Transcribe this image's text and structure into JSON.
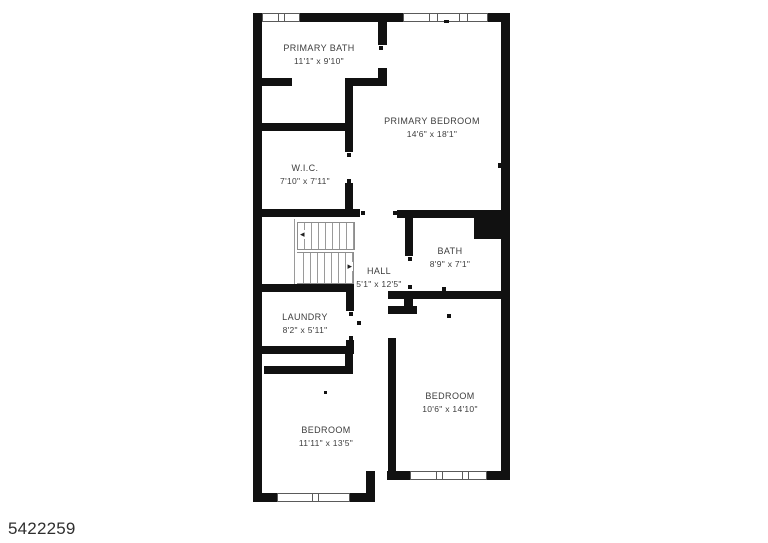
{
  "plan": {
    "listing_id": "5422259",
    "rooms": [
      {
        "name": "PRIMARY BATH",
        "dims": "11'1\" x 9'10\""
      },
      {
        "name": "PRIMARY BEDROOM",
        "dims": "14'6\" x 18'1\""
      },
      {
        "name": "W.I.C.",
        "dims": "7'10\" x 7'11\""
      },
      {
        "name": "HALL",
        "dims": "5'1\" x 12'5\""
      },
      {
        "name": "BATH",
        "dims": "8'9\" x 7'1\""
      },
      {
        "name": "LAUNDRY",
        "dims": "8'2\" x 5'11\""
      },
      {
        "name": "BEDROOM",
        "dims": "10'6\" x 14'10\""
      },
      {
        "name": "BEDROOM",
        "dims": "11'11\" x 13'5\""
      }
    ]
  },
  "icons": {
    "stair_arrow_up": "◂",
    "stair_arrow_down": "▸"
  },
  "colors": {
    "wall": "#111111",
    "label_text": "#3d3d3d",
    "window_line": "#5a5a5a",
    "id_text": "#2f2f2f"
  }
}
